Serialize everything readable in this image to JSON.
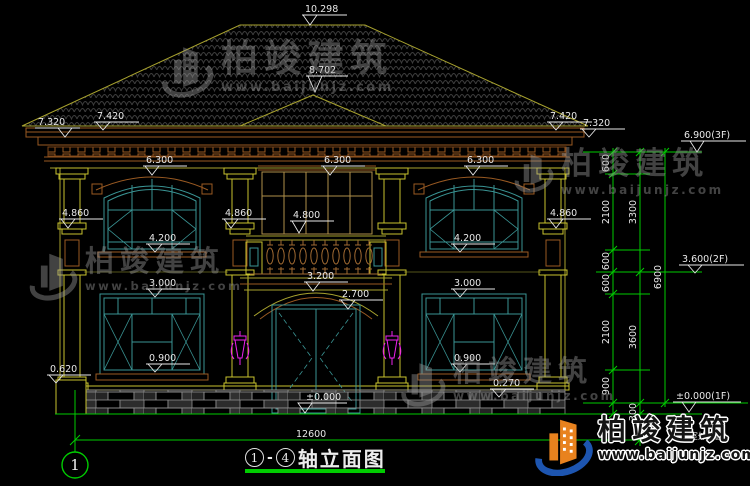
{
  "drawing": {
    "title": {
      "axis_from": "1",
      "axis_sep": "-",
      "axis_to": "4",
      "label": "轴立面图"
    },
    "axis_bubble_left": "1",
    "ground_note": "(室外地面)"
  },
  "elevation_marks": {
    "ridge": "10.298",
    "bay_ridge": "8.702",
    "eave_outer_left": "7.320",
    "eave_inner_left": "7.420",
    "eave_inner_right": "7.420",
    "eave_outer_right": "7.320",
    "win2f_head_left": "6.300",
    "win2f_head_center": "6.300",
    "win2f_head_right": "6.300",
    "capital_left": "4.860",
    "capital_center": "4.860",
    "capital_right": "4.860",
    "balcony_rail": "4.800",
    "win2f_sill_left": "4.200",
    "win2f_sill_right": "4.200",
    "entry_arch": "3.200",
    "door_head": "2.700",
    "win1f_head_left": "3.000",
    "win1f_head_right": "3.000",
    "win1f_sill_left": "0.900",
    "win1f_sill_right": "0.900",
    "plinth_left": "0.620",
    "plinth_right": "0.270",
    "floor_zero": "±0.000"
  },
  "floor_levels": {
    "f3": "6.900(3F)",
    "f2": "3.600(2F)",
    "f1": "±0.000(1F)"
  },
  "dim_chain": {
    "col_inner": [
      "600",
      "2100",
      "600",
      "600",
      "2100",
      "900"
    ],
    "col_mid": [
      "3300",
      "3600",
      "300"
    ],
    "col_outer": "6900",
    "total_width": "12600"
  },
  "watermark": {
    "brand": "柏竣建筑",
    "url": "www.baijunjz.com"
  },
  "logo": {
    "brand": "柏竣建筑",
    "url": "www.baijunjz.com"
  },
  "colors": {
    "background": "#000000",
    "line_olive": "#a8a22e",
    "line_teal": "#3a9595",
    "line_brown": "#9a5a22",
    "line_green": "#00cc00",
    "lamp_magenta": "#ee22ee",
    "text": "#e8e8e8",
    "logo_orange": "#e8821e",
    "logo_blue": "#1d55b0"
  }
}
